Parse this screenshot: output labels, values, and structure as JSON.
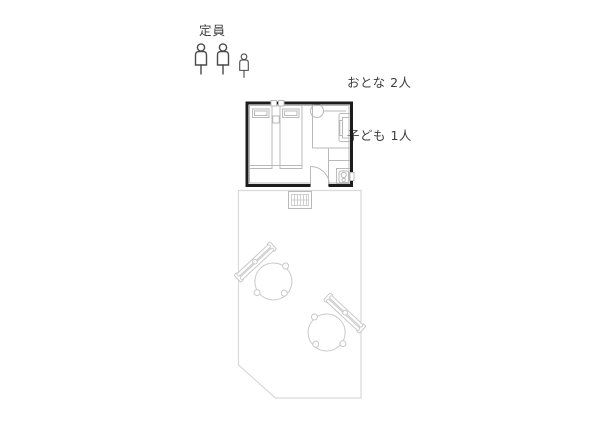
{
  "header": {
    "capacity_label": "定員",
    "occupancy": {
      "adults_label": "おとな 2人",
      "children_label": "子ども 1人"
    }
  },
  "capacity_icons": [
    "adult-person-icon",
    "adult-person-icon",
    "child-person-icon"
  ],
  "floorplan": {
    "room_elements": [
      "bed-left",
      "bed-right",
      "pillow",
      "pillow",
      "headboard-panels",
      "round-table",
      "lounge-chair",
      "partition-walls",
      "kitchenette-unit",
      "stove-icon",
      "door-swing",
      "entrance-opening"
    ],
    "outside_elements": [
      "entrance-mat",
      "terrace-deck",
      "garden-chair",
      "garden-chair"
    ]
  },
  "colors": {
    "wall": "#1c1c1c",
    "furniture": "#b9b9b9",
    "furniture_light": "#cfcfcf",
    "terrace": "#d9d9d9",
    "chair": "#c9c9c9",
    "text": "#3d3d3d",
    "icon": "#4a4a4a"
  }
}
